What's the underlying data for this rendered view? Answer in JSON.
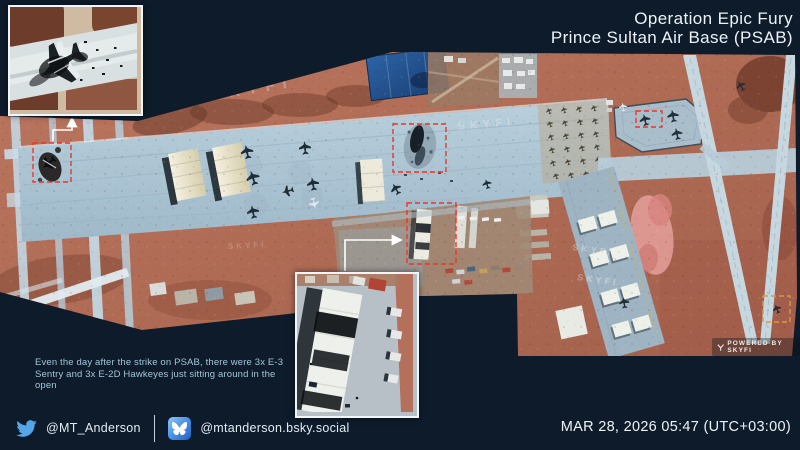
{
  "header": {
    "title_line1": "Operation Epic Fury",
    "title_line2": "Prince Sultan Air Base (PSAB)"
  },
  "caption": {
    "lines": [
      "Even the day after the strike on PSAB, there were 3x E-3",
      "Sentry and 3x E-2D Hawkeyes just sitting around in the",
      "open"
    ]
  },
  "footer": {
    "twitter_handle": "@MT_Anderson",
    "bluesky_handle": "@mtanderson.bsky.social",
    "timestamp": "MAR 28, 2026 05:47 (UTC+03:00)"
  },
  "watermarks": {
    "tile": "SKYFI",
    "provider": "POWERED BY SKYFI"
  },
  "icons": {
    "twitter": "twitter-bird-icon",
    "bluesky": "bluesky-app-icon",
    "skyfi": "skyfi-logo-icon"
  },
  "colors": {
    "background": "#0d1b2b",
    "annotation_red": "#ee3526",
    "annotation_orange": "#d89a43",
    "twitter_blue": "#55a6e8",
    "bluesky_blue": "#2d6fd2",
    "caption_text": "#a4c6d8"
  }
}
